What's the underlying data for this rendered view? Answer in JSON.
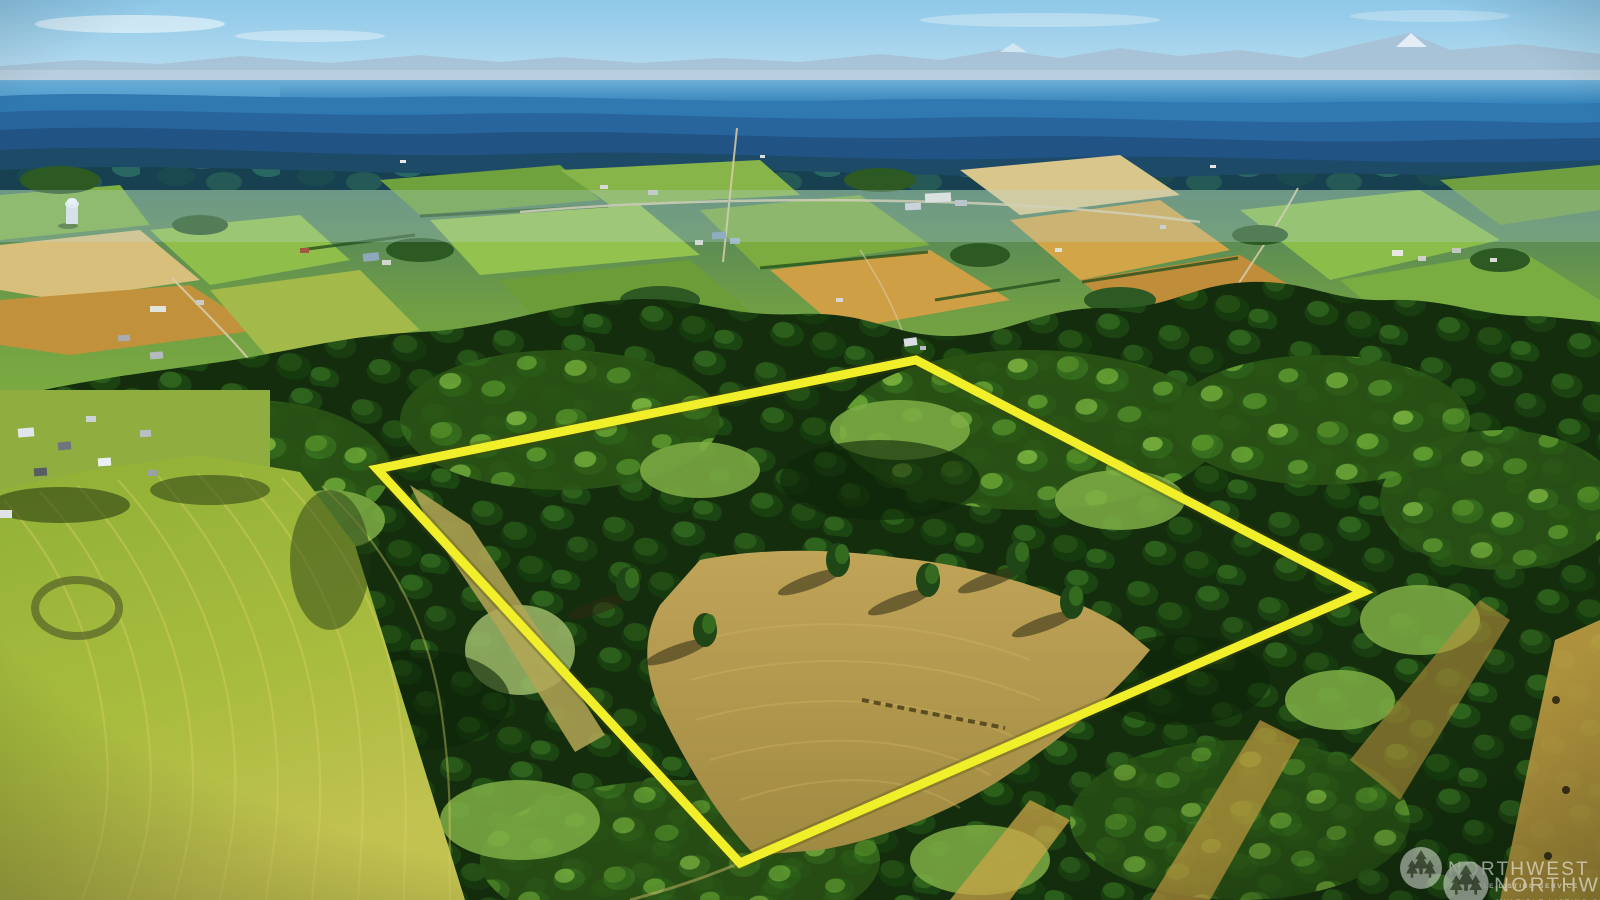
{
  "photo": {
    "kind": "aerial-drone-listing-photo",
    "scene": "rural wooded acreage with highlighted parcel, farm valley, distant mountains and water"
  },
  "boundary": {
    "points": "377,469 916,360 1363,592 740,863",
    "color": "#f1ee2a",
    "underlay_color": "#4a4a05"
  },
  "watermark": {
    "brand": "NORTHWEST",
    "tagline": "MULTIPLE LISTING SERVICE",
    "logo": "three-evergreen-trees-in-circle",
    "color": "#ffffff",
    "opacity": "0.55"
  }
}
